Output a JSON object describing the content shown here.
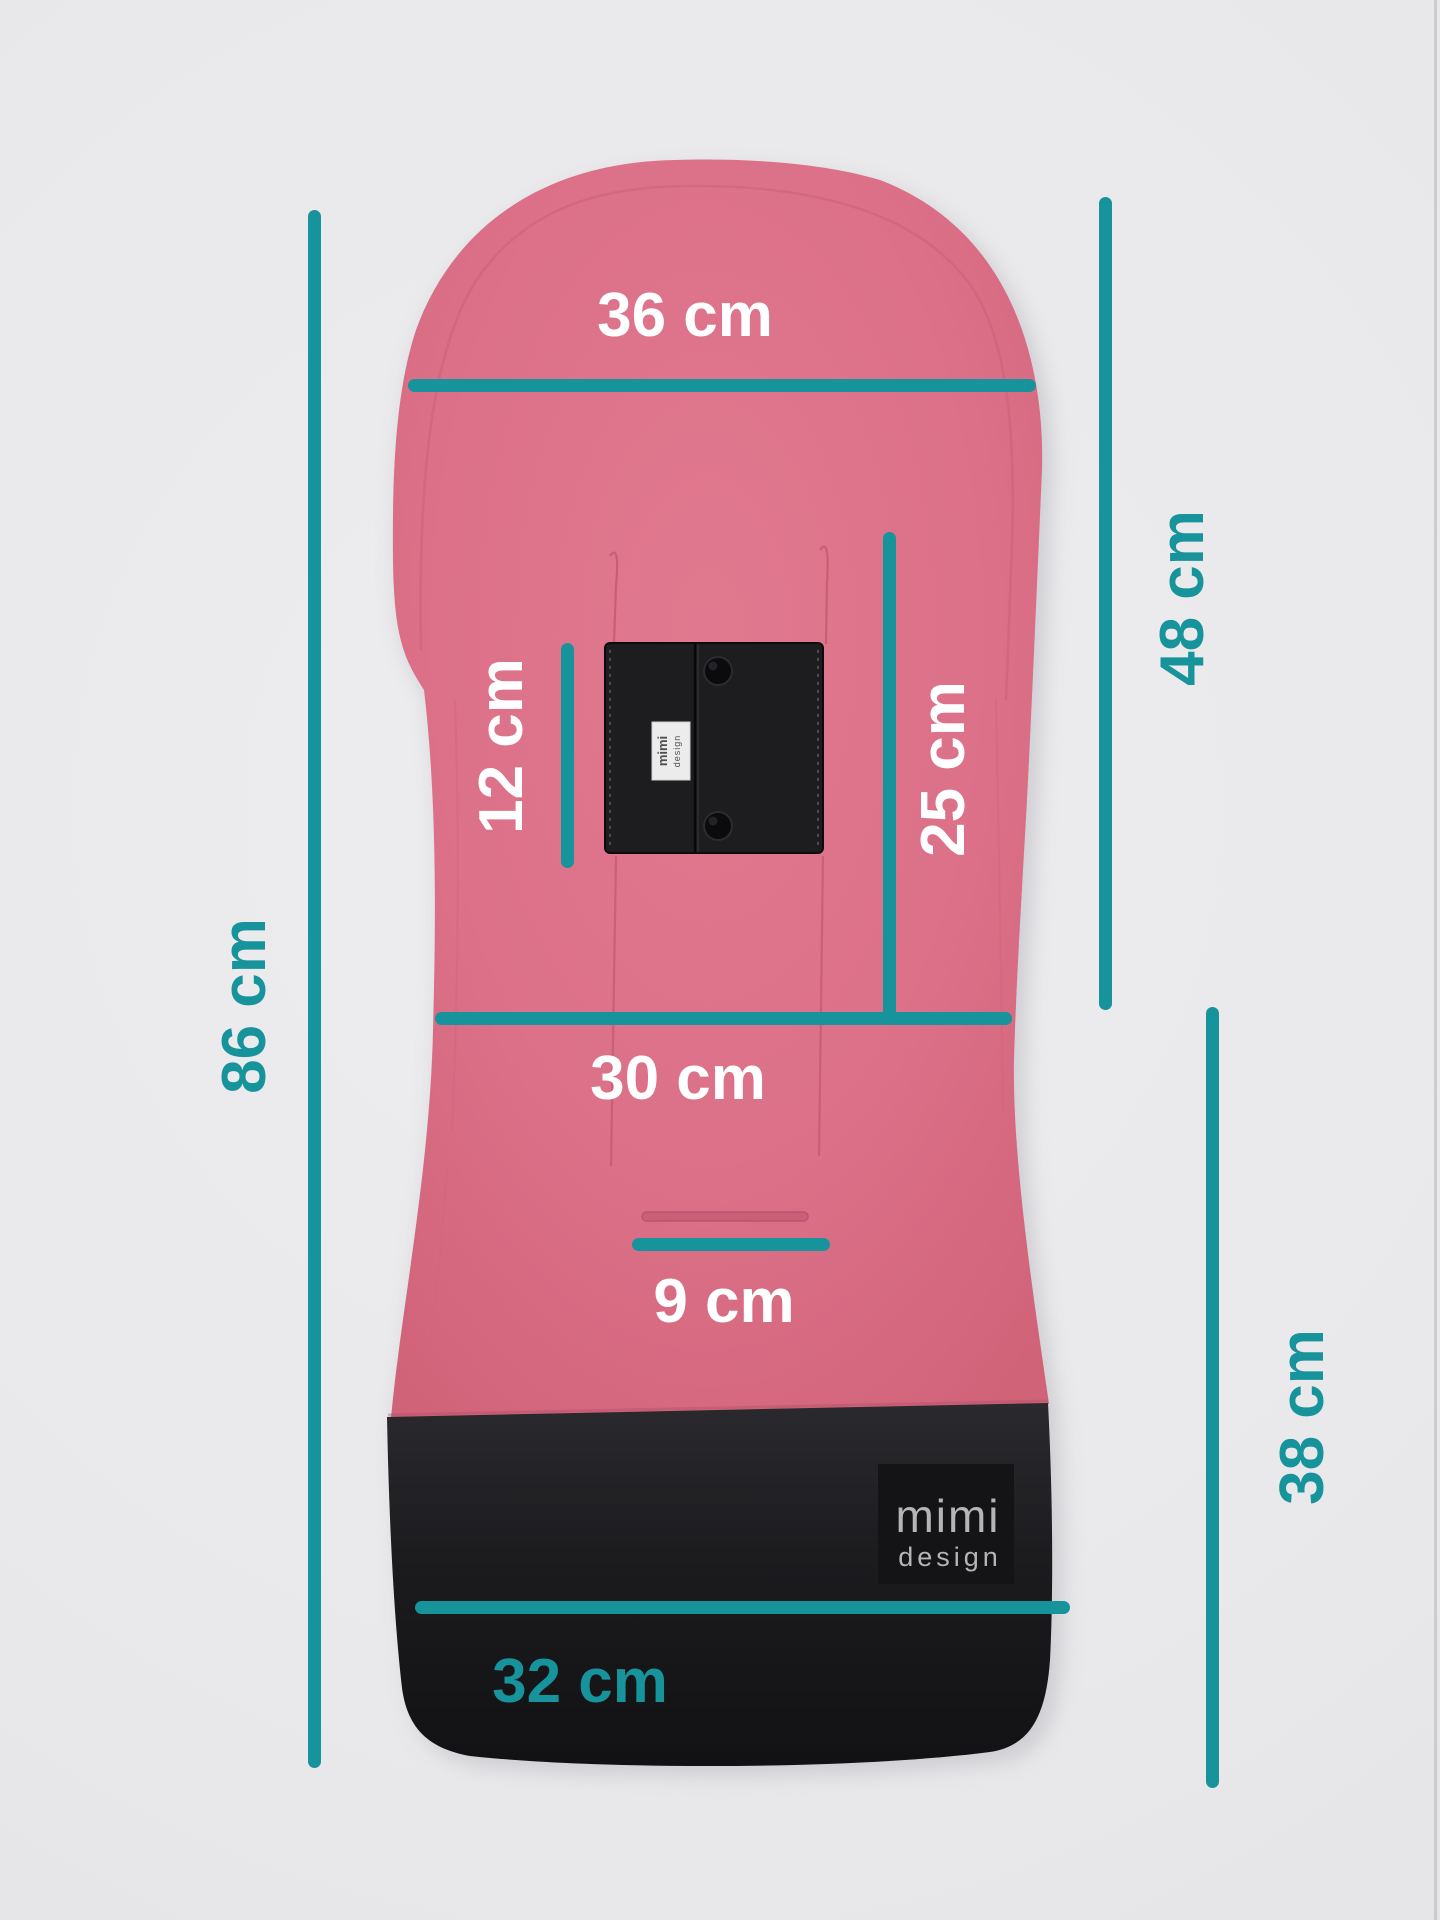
{
  "colors": {
    "teal": "#17939c",
    "white": "#ffffff",
    "pink": "#dc7189",
    "pink_dark": "#c45a72",
    "background": "#e9e9eb",
    "fabric_black": "#1d1d20",
    "logo_gray": "#b5b5b7"
  },
  "measurements": [
    {
      "id": "top-width",
      "label": "36 cm",
      "value_cm": 36,
      "orientation": "horizontal",
      "color": "white"
    },
    {
      "id": "upper-height",
      "label": "48 cm",
      "value_cm": 48,
      "orientation": "vertical",
      "color": "teal"
    },
    {
      "id": "patch-height",
      "label": "12 cm",
      "value_cm": 12,
      "orientation": "vertical",
      "color": "white"
    },
    {
      "id": "middle-height",
      "label": "25 cm",
      "value_cm": 25,
      "orientation": "vertical",
      "color": "white"
    },
    {
      "id": "total-height",
      "label": "86 cm",
      "value_cm": 86,
      "orientation": "vertical",
      "color": "teal"
    },
    {
      "id": "middle-width",
      "label": "30 cm",
      "value_cm": 30,
      "orientation": "horizontal",
      "color": "white"
    },
    {
      "id": "slot-width",
      "label": "9 cm",
      "value_cm": 9,
      "orientation": "horizontal",
      "color": "white"
    },
    {
      "id": "lower-height",
      "label": "38 cm",
      "value_cm": 38,
      "orientation": "vertical",
      "color": "teal"
    },
    {
      "id": "bottom-width",
      "label": "32 cm",
      "value_cm": 32,
      "orientation": "horizontal",
      "color": "teal"
    }
  ],
  "branding": {
    "logo_line1": "mimi",
    "logo_line2": "design"
  }
}
